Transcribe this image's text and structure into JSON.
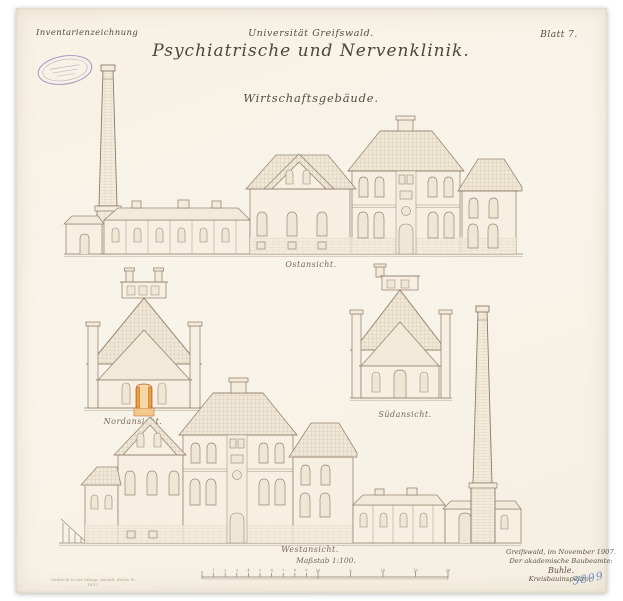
{
  "sheet": {
    "corner_note": "Inventarienzeichnung",
    "blatt": "Blatt 7.",
    "title": {
      "institution": "Universität Greifswald.",
      "main": "Psychiatrische und Nervenklinik.",
      "subtitle": "Wirtschaftsgebäude."
    }
  },
  "views": {
    "east": {
      "label": "Ostansicht."
    },
    "north": {
      "label": "Nordansicht."
    },
    "south": {
      "label": "Südansicht."
    },
    "west": {
      "label": "Westansicht."
    }
  },
  "scale": {
    "label": "Maßstab 1:100.",
    "minor_ticks": [
      "1",
      "2",
      "3",
      "4",
      "5",
      "6",
      "7",
      "8",
      "9",
      "10"
    ],
    "major_ticks": [
      "5",
      "10",
      "15",
      "20"
    ]
  },
  "signature": {
    "place_date": "Greifswald, im November 1907.",
    "role": "Der akademische Baubeamte:",
    "name": "Buhle.",
    "title": "Kreisbauinspektor."
  },
  "imprint": {
    "line1": "Gedruckt in der lithogr. Anstalt, Berlin W.",
    "line2": "1907."
  },
  "archive_number": "3899",
  "colors": {
    "paper": "#f8f3e8",
    "ink": "#9a8672",
    "text": "#564c40",
    "accent_orange": "#e8a345",
    "stamp_purple": "#8a7ab5",
    "number_blue": "#7390c7"
  }
}
